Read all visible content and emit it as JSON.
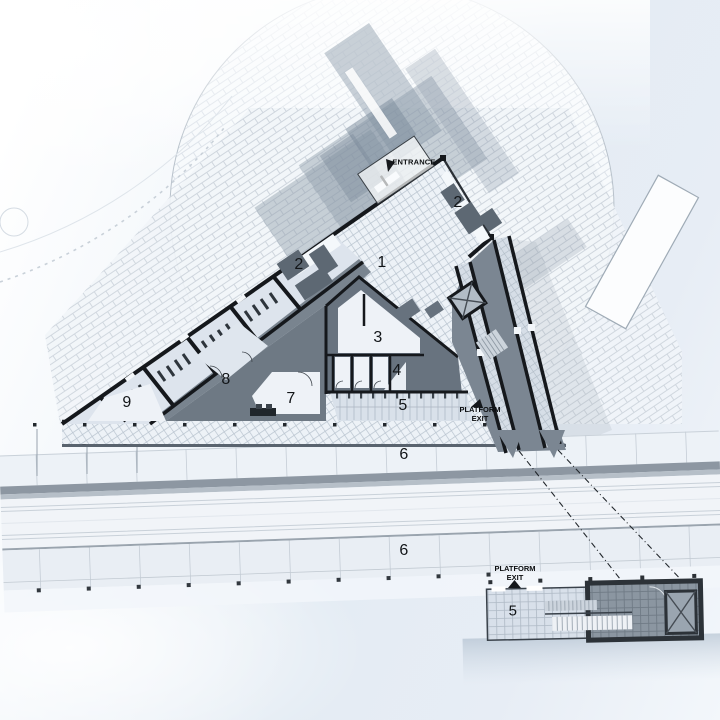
{
  "labels": {
    "entrance": "ENTRANCE",
    "platform": "PLATFORM",
    "exit": "EXIT",
    "rooms": {
      "r1": "1",
      "r2": "2",
      "r3": "3",
      "r4": "4",
      "r5": "5",
      "r6": "6",
      "r7": "7",
      "r8": "8",
      "r9": "9"
    }
  },
  "colors": {
    "wall_dark": "#15181c",
    "slate_zone": "#6b7682",
    "south_band": "#59636e",
    "corridor_gray": "#79848f",
    "room_light": "#eef2f7",
    "tile_line": "#b9c4cf",
    "brick_line": "#cdd4dc",
    "platform_edge": "#8d97a2",
    "track_line": "#c9d1d9",
    "inset_wall": "#2c3238",
    "inset_interior": "#8b96a1",
    "background_blue": "#e4ecf4",
    "canopy_shadow": "#8a99a8",
    "label_text": "#121518"
  }
}
